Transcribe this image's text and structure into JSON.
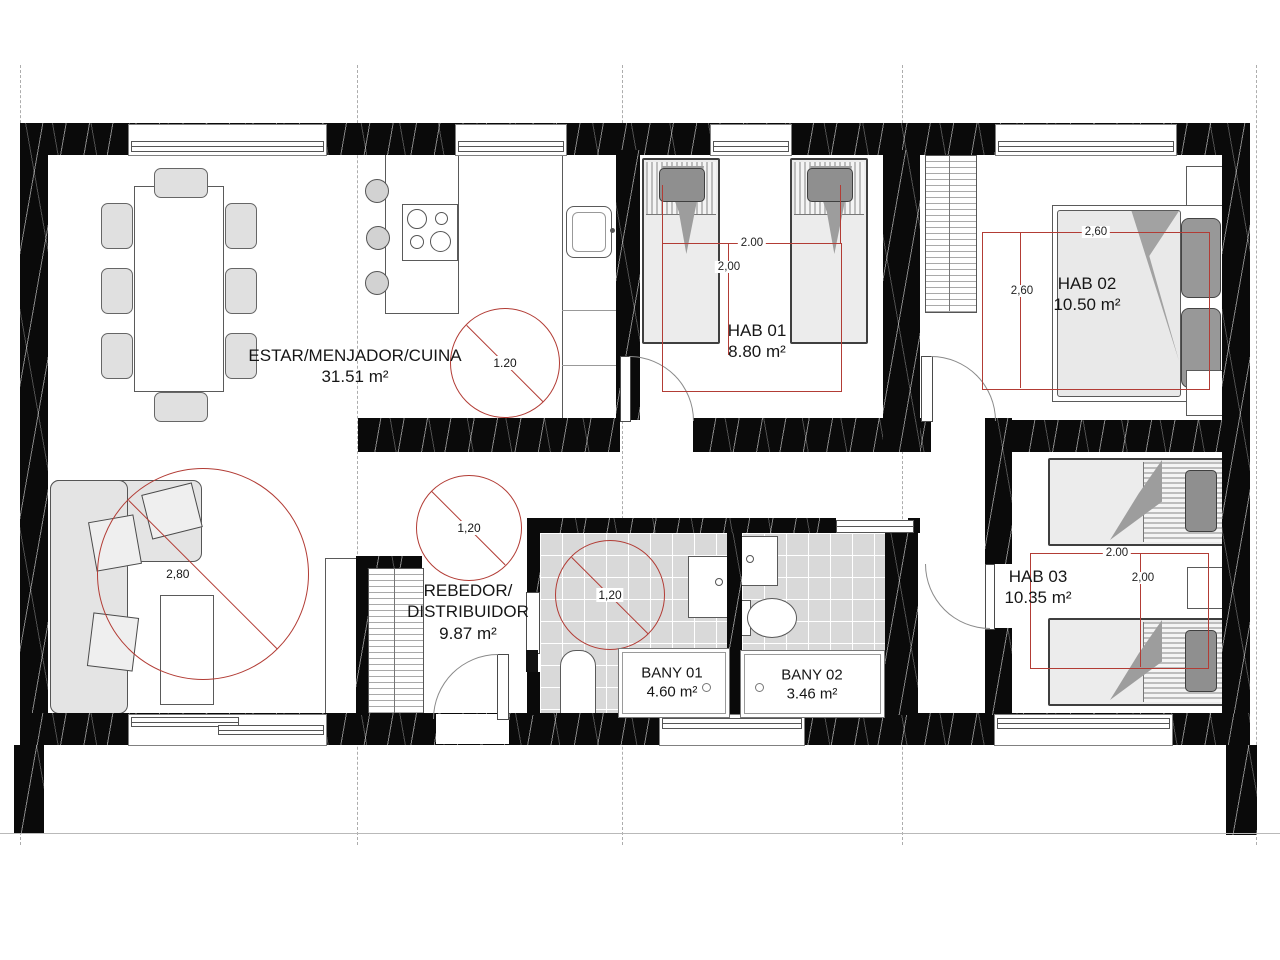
{
  "plan": {
    "rooms": [
      {
        "id": "estar",
        "name": "ESTAR/MENJADOR/CUINA",
        "area": "31.51 m²"
      },
      {
        "id": "rebedor",
        "line1": "REBEDOR/",
        "line2": "DISTRIBUIDOR",
        "area": "9.87 m²"
      },
      {
        "id": "hab01",
        "name": "HAB 01",
        "area": "8.80 m²"
      },
      {
        "id": "hab02",
        "name": "HAB 02",
        "area": "10.50 m²"
      },
      {
        "id": "hab03",
        "name": "HAB 03",
        "area": "10.35 m²"
      },
      {
        "id": "bany01",
        "name": "BANY 01",
        "area": "4.60 m²"
      },
      {
        "id": "bany02",
        "name": "BANY 02",
        "area": "3.46 m²"
      }
    ],
    "dims": {
      "living_diameter": "2,80",
      "kitchen_diameter": "1.20",
      "hall_diameter": "1,20",
      "bath_diameter": "1,20",
      "hab01_w": "2.00",
      "hab01_d": "2,00",
      "hab02_w": "2,60",
      "hab02_d": "2,60",
      "hab03_w": "2.00",
      "hab03_d": "2,00"
    },
    "colors": {
      "wall": "#0a0a0a",
      "dimension_red": "#b23c35",
      "tile": "#d9d9d9"
    }
  }
}
